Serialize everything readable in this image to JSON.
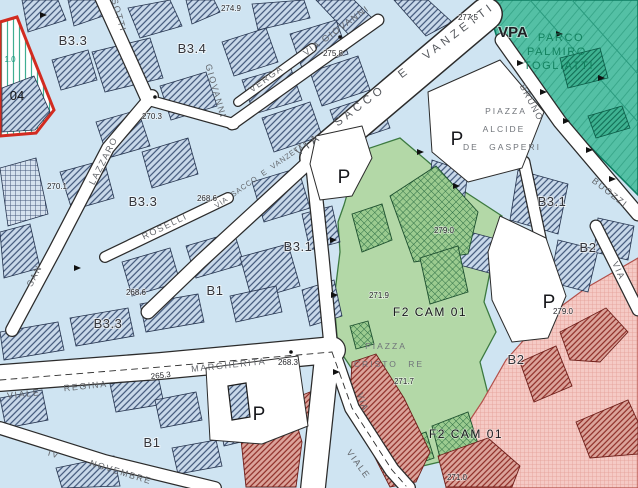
{
  "map_type": "urban-zoning-plan",
  "colors": {
    "background": "#cfe4f2",
    "street": "#ffffff",
    "park": "#54c0a5",
    "park_text": "#13825f",
    "green_zone": "#b3d8a7",
    "pink_zone": "#f5cac5",
    "building_fill": "#c9d9ea",
    "building_hatch": "#3f5578",
    "red_building": "#9c3430",
    "parcel_outline": "#d22b20"
  },
  "labels": {
    "zones": [
      {
        "text": "B3.3"
      },
      {
        "text": "B3.4"
      },
      {
        "text": "B3.3"
      },
      {
        "text": "B3.1"
      },
      {
        "text": "B1"
      },
      {
        "text": "B3.3"
      },
      {
        "text": "B1"
      },
      {
        "text": "B3.1"
      },
      {
        "text": "B2"
      },
      {
        "text": "B2"
      },
      {
        "text": "VPA"
      },
      {
        "text": "F2 CAM 01"
      },
      {
        "text": "F2 CAM 01"
      },
      {
        "text": "04"
      }
    ],
    "streets": [
      {
        "text": "SOTTI"
      },
      {
        "text": "VIA GIOVANNI"
      },
      {
        "text": "VERGA"
      },
      {
        "text": "GIOVANNI"
      },
      {
        "text": "VIA SACCO E VANZETTI"
      },
      {
        "text": "VIA SACCO E VANZETTI"
      },
      {
        "text": "LAZZARO"
      },
      {
        "text": "SAN"
      },
      {
        "text": "ROSELLI"
      },
      {
        "text": "VIALE"
      },
      {
        "text": "REGINA"
      },
      {
        "text": "MARGHERITA"
      },
      {
        "text": "IV"
      },
      {
        "text": "NOVEMBRE"
      },
      {
        "text": "VIALE"
      },
      {
        "text": "VIA"
      },
      {
        "text": "BRUNO"
      },
      {
        "text": "BUOZZI"
      },
      {
        "text": "VIA"
      }
    ],
    "piazzas": {
      "de_gasperi": {
        "l1": "PIAZZA",
        "l2": "ALCIDE",
        "l3": "DE GASPERI"
      },
      "cristo_re": {
        "l1": "PIAZZA",
        "l2": "CRISTO RE"
      }
    },
    "park": {
      "l1": "PARCO",
      "l2": "PALMIRO",
      "l3": "TOGLIATTI"
    },
    "parking_symbol": "P",
    "elevations": [
      {
        "text": "274.9"
      },
      {
        "text": "277.5"
      },
      {
        "text": "275.8"
      },
      {
        "text": "270.3"
      },
      {
        "text": "270.1"
      },
      {
        "text": "268.6"
      },
      {
        "text": "268.6"
      },
      {
        "text": "271.9"
      },
      {
        "text": "268.3"
      },
      {
        "text": "271.7"
      },
      {
        "text": "279.0"
      },
      {
        "text": "279.0"
      },
      {
        "text": "271.0"
      },
      {
        "text": "265.3"
      },
      {
        "text": "1.0"
      }
    ]
  }
}
